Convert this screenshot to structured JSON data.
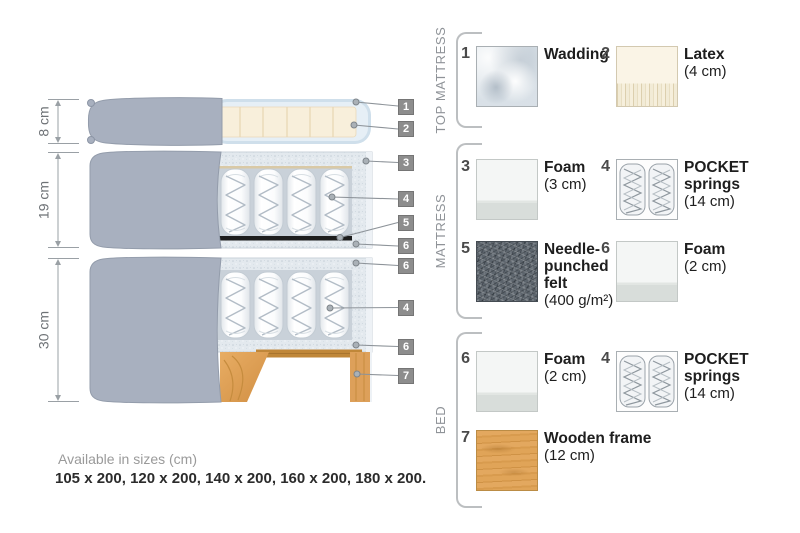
{
  "dimensions": [
    {
      "label": "8 cm"
    },
    {
      "label": "19 cm"
    },
    {
      "label": "30 cm"
    }
  ],
  "tags": [
    "1",
    "2",
    "3",
    "4",
    "5",
    "6",
    "6",
    "4",
    "6",
    "7"
  ],
  "legend": {
    "sections": [
      {
        "title": "TOP MATTRESS",
        "items": [
          {
            "number": "1",
            "label": "Wadding",
            "size": ""
          },
          {
            "number": "2",
            "label": "Latex",
            "size": "(4 cm)"
          }
        ]
      },
      {
        "title": "MATTRESS",
        "items": [
          {
            "number": "3",
            "label": "Foam",
            "size": "(3 cm)"
          },
          {
            "number": "4",
            "label": "POCKET\nsprings",
            "size": "(14 cm)"
          },
          {
            "number": "5",
            "label": "Needle-\npunched\nfelt",
            "size": "(400 g/m²)"
          },
          {
            "number": "6",
            "label": "Foam",
            "size": "(2 cm)"
          }
        ]
      },
      {
        "title": "BED",
        "items": [
          {
            "number": "6",
            "label": "Foam",
            "size": "(2 cm)"
          },
          {
            "number": "4",
            "label": "POCKET\nsprings",
            "size": "(14 cm)"
          },
          {
            "number": "7",
            "label": "Wooden frame",
            "size": "(12 cm)"
          }
        ]
      }
    ]
  },
  "footer": {
    "note": "Available in sizes (cm)",
    "sizes": "105 x 200, 120 x 200, 140 x 200, 160 x 200, 180 x 200."
  },
  "colors": {
    "fabric_gray": "#a8b0bf",
    "wadding_blue": "#dce8f1",
    "latex_cream": "#f8efdb",
    "foam_speckle": "#e3e9ee",
    "felt_black": "#1d1d1d",
    "wood_orange": "#dda05a",
    "tag_gray": "#8d8d8d"
  }
}
